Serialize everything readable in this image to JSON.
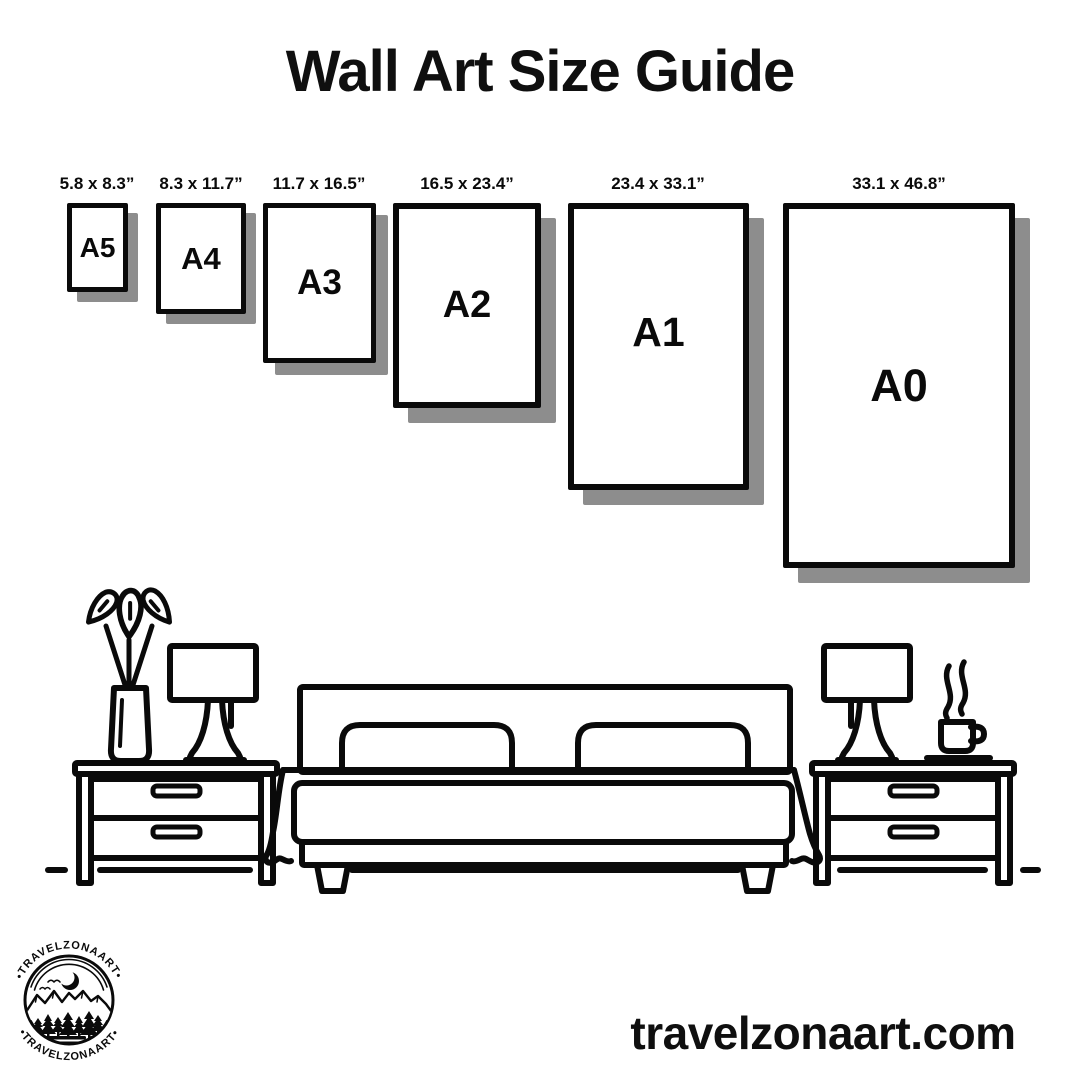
{
  "title": "Wall Art Size Guide",
  "sizes": [
    {
      "name": "A5",
      "dimensions": "5.8 x 8.3”"
    },
    {
      "name": "A4",
      "dimensions": "8.3 x 11.7”"
    },
    {
      "name": "A3",
      "dimensions": "11.7 x 16.5”"
    },
    {
      "name": "A2",
      "dimensions": "16.5 x 23.4”"
    },
    {
      "name": "A1",
      "dimensions": "23.4 x 33.1”"
    },
    {
      "name": "A0",
      "dimensions": "33.1 x 46.8”"
    }
  ],
  "logo": {
    "arc_text_top": "•TRAVELZONAART•",
    "arc_text_bottom": "•TRAVELZONAART•"
  },
  "footer": {
    "website": "travelzonaart.com"
  },
  "colors": {
    "ink": "#0a0a0a",
    "paper_shadow": "#8d8d8d",
    "background": "#ffffff"
  }
}
